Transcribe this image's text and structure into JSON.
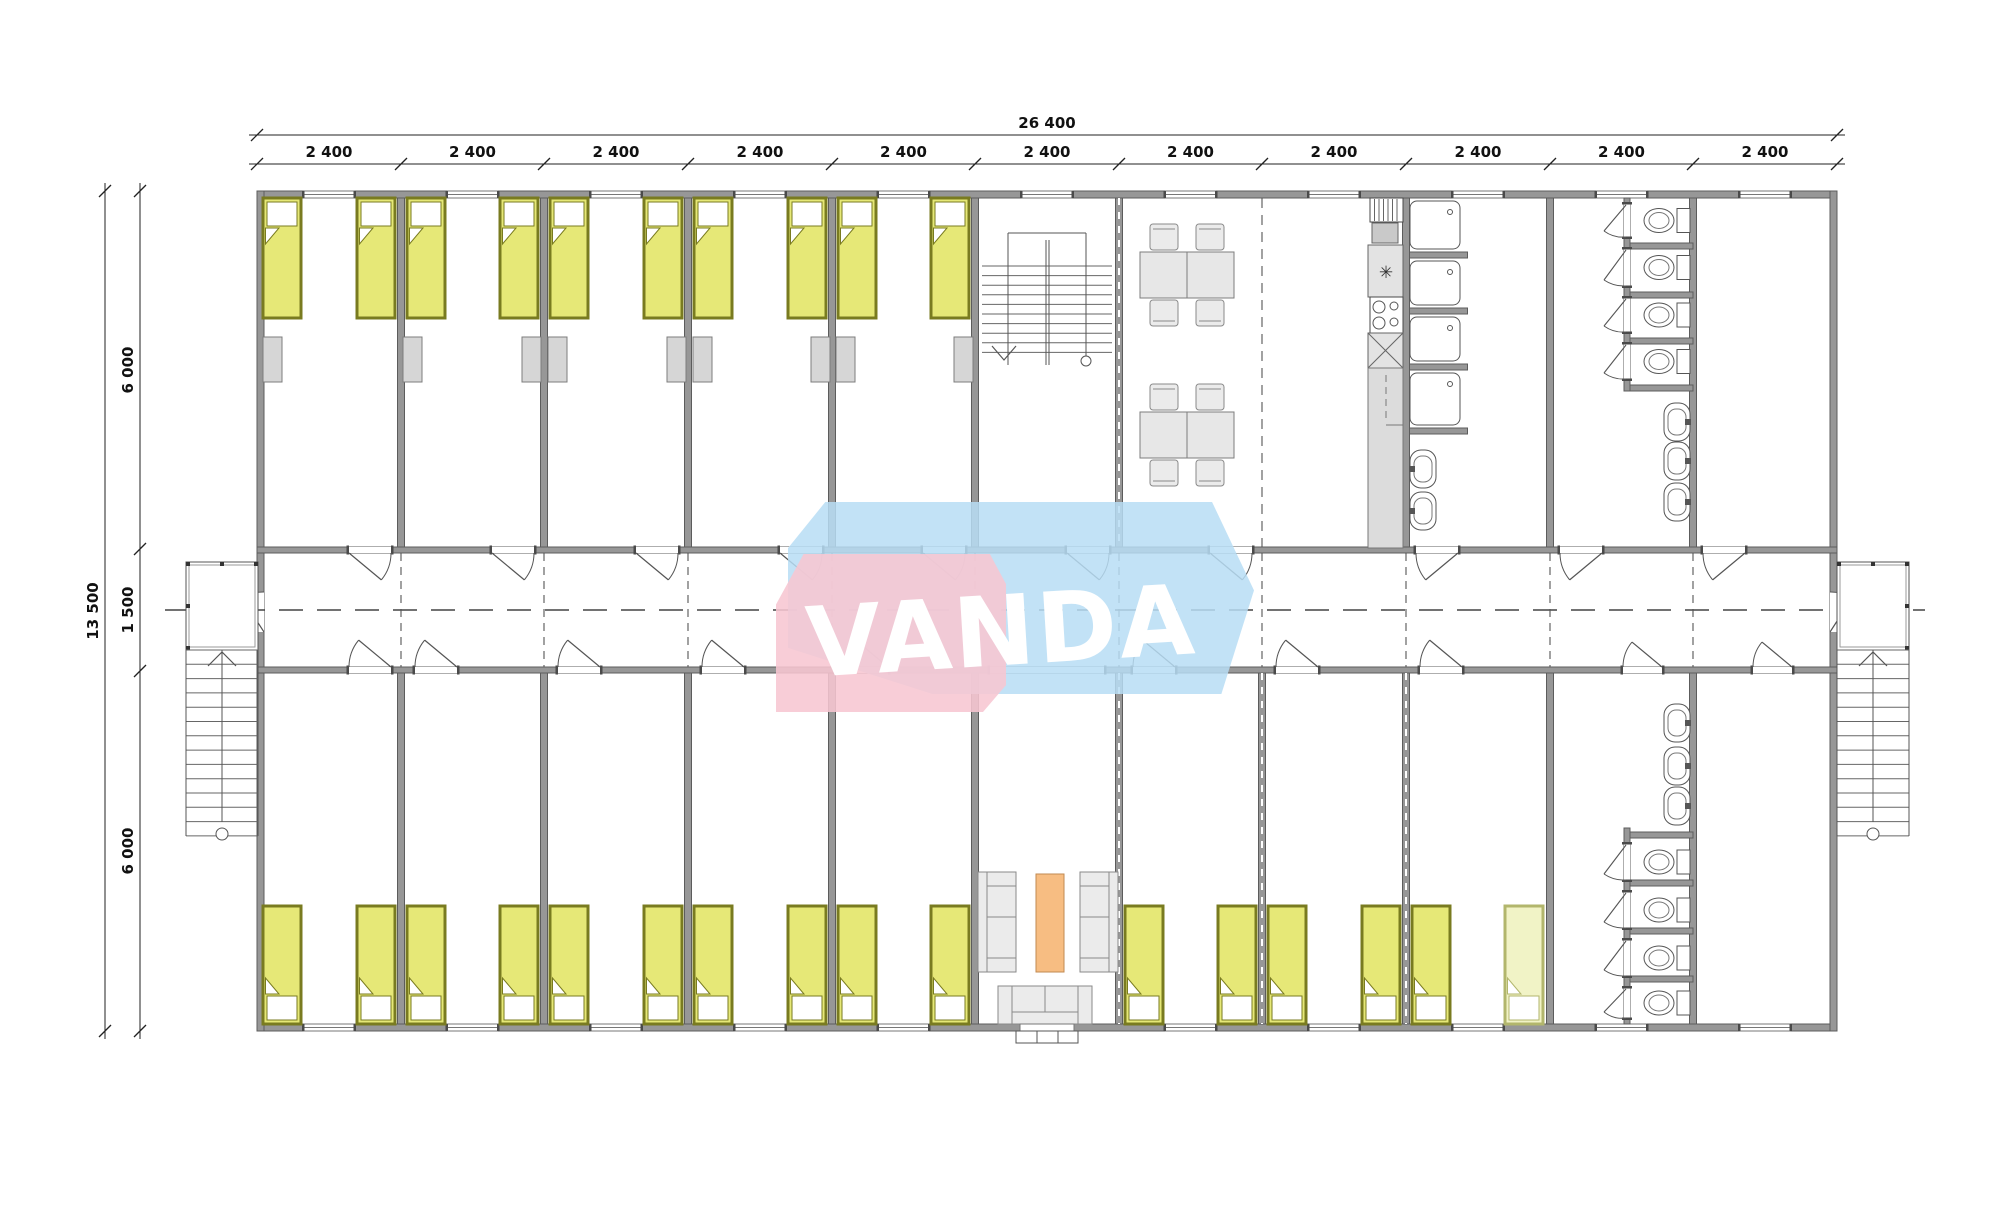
{
  "watermark": {
    "text": "VANDA",
    "pink": "#f7c6d1",
    "blue": "#b7ddf5"
  },
  "dimensions": {
    "top_total_label": "26 400",
    "top_bay_labels": [
      "2 400",
      "2 400",
      "2 400",
      "2 400",
      "2 400",
      "2 400",
      "2 400",
      "2 400",
      "2 400",
      "2 400",
      "2 400"
    ],
    "left_total_label": "13 500",
    "left_segment_labels": [
      "6 000",
      "1 500",
      "6 000"
    ]
  },
  "colors": {
    "wall_fill": "#979797",
    "wall_stroke": "#5c5c5c",
    "line": "#4a4a4a",
    "dim_text": "#111111",
    "bed_fill": "#e6e877",
    "bed_stroke": "#797b20",
    "bed_pale_fill": "#f1f3c6",
    "bed_pale_stroke": "#b2b66c",
    "wardrobe_fill": "#d6d6d6",
    "furniture_fill": "#ebebeb",
    "furniture_stroke": "#8a8a8a",
    "accent_orange": "#f7bd82",
    "accent_orange_stroke": "#c28a52"
  },
  "fixtures": {
    "bed_icon_count": 26,
    "wardrobe_icon_count": 9,
    "toilet_icon_count": 8,
    "shower_icon_count": 4,
    "sink_icon_count": 10,
    "dining_table_groups": 2,
    "chairs_per_table": 4,
    "sofa_icon_count": 3,
    "staircase_icon_count": 3
  }
}
